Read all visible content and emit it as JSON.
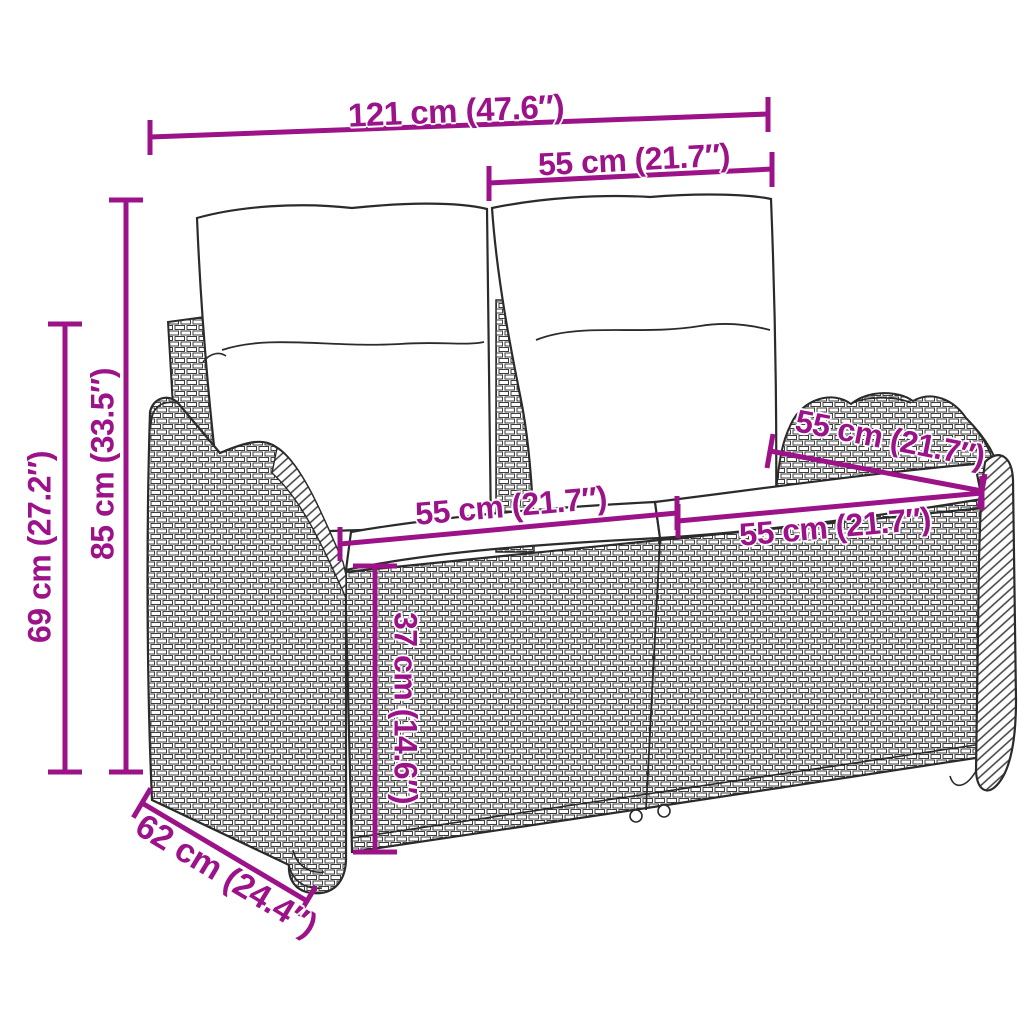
{
  "diagram": {
    "subject": "poly-rattan garden bench with cushions",
    "accent_color": "#9C1389",
    "line_art_color": "#2b2b2b",
    "dimensions": {
      "total_width": "121 cm (47.6″)",
      "backrest_section_width": "55 cm (21.7″)",
      "total_height": "85 cm (33.5″)",
      "armrest_height": "69 cm (27.2″)",
      "seat_width_left": "55 cm (21.7″)",
      "seat_width_right": "55 cm (21.7″)",
      "seat_depth_top": "55 cm (21.7″)",
      "seat_height": "37 cm (14.6″)",
      "base_depth": "62 cm (24.4″)"
    }
  }
}
